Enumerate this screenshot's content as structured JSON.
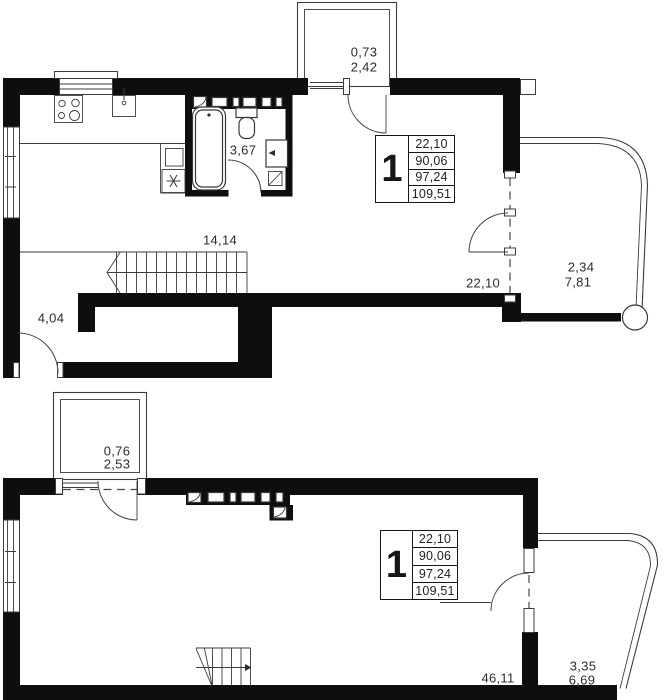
{
  "colors": {
    "wall": "#0e0e0e",
    "line": "#3c3c3c",
    "text": "#2d2d2d"
  },
  "upper_plan": {
    "top_balcony": {
      "coef_area": "0,73",
      "area": "2,42"
    },
    "bathroom_area": "3,67",
    "hall_area": "14,14",
    "entry_area": "4,04",
    "living_area": "22,10",
    "right_balcony": {
      "coef_area": "2,34",
      "area": "7,81"
    },
    "info_box": {
      "number": "1",
      "rows": [
        "22,10",
        "90,06",
        "97,24",
        "109,51"
      ]
    }
  },
  "lower_plan": {
    "top_balcony": {
      "coef_area": "0,76",
      "area": "2,53"
    },
    "living_area": "46,11",
    "right_balcony": {
      "coef_area": "3,35",
      "area": "6,69"
    },
    "info_box": {
      "number": "1",
      "rows": [
        "22,10",
        "90,06",
        "97,24",
        "109,51"
      ]
    }
  }
}
